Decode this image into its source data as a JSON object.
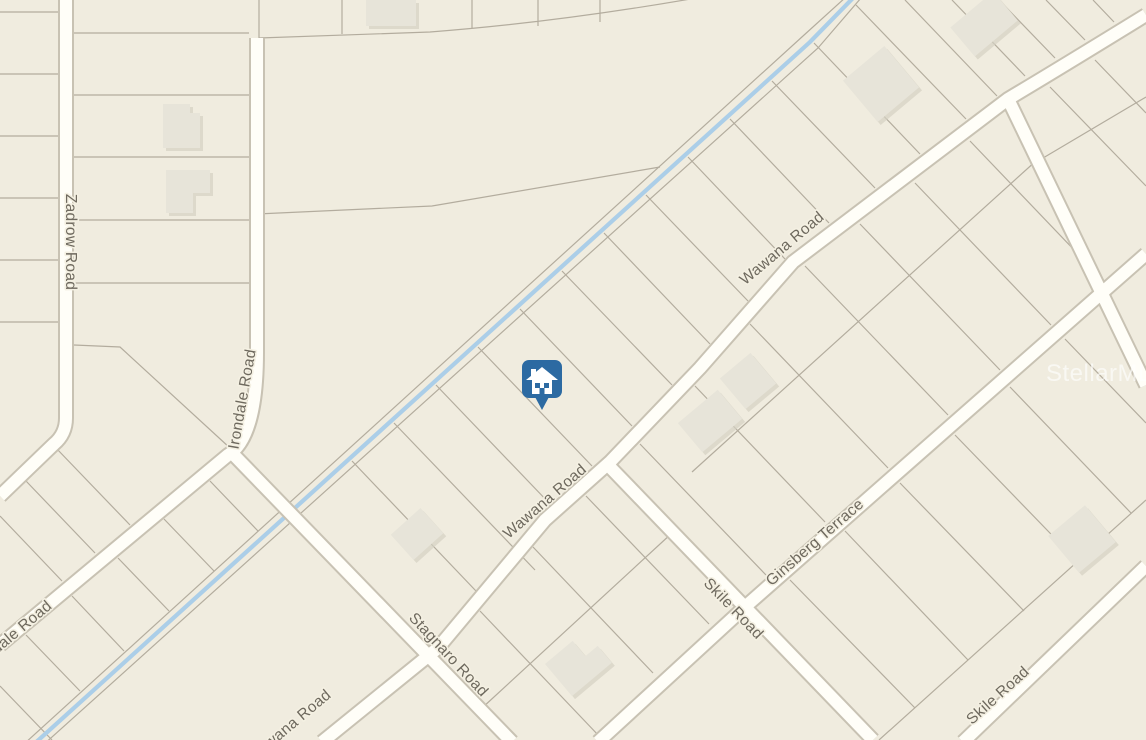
{
  "map": {
    "watermark": "StellarMLS",
    "marker": {
      "type": "house-pin",
      "color": "#2c6aa2"
    },
    "palette": {
      "background": "#f0ecdf",
      "road_fill": "#fffef8",
      "road_casing": "#c8c2b3",
      "parcel_line": "#a9a293",
      "stream": "#abcee8",
      "building": "#e7e4d9",
      "label_text": "#6e695e"
    },
    "roads": {
      "zadrow": "Zadrow Road",
      "irondale": "Irondale Road",
      "irondale_sw": "Irondale Road",
      "wawana_ne": "Wawana Road",
      "wawana_mid": "Wawana Road",
      "wawana_sw": "Wawana Road",
      "stagnaro": "Stagnaro Road",
      "skile_1": "Skile Road",
      "skile_2": "Skile Road",
      "ginsberg": "Ginsberg Terrace"
    }
  }
}
